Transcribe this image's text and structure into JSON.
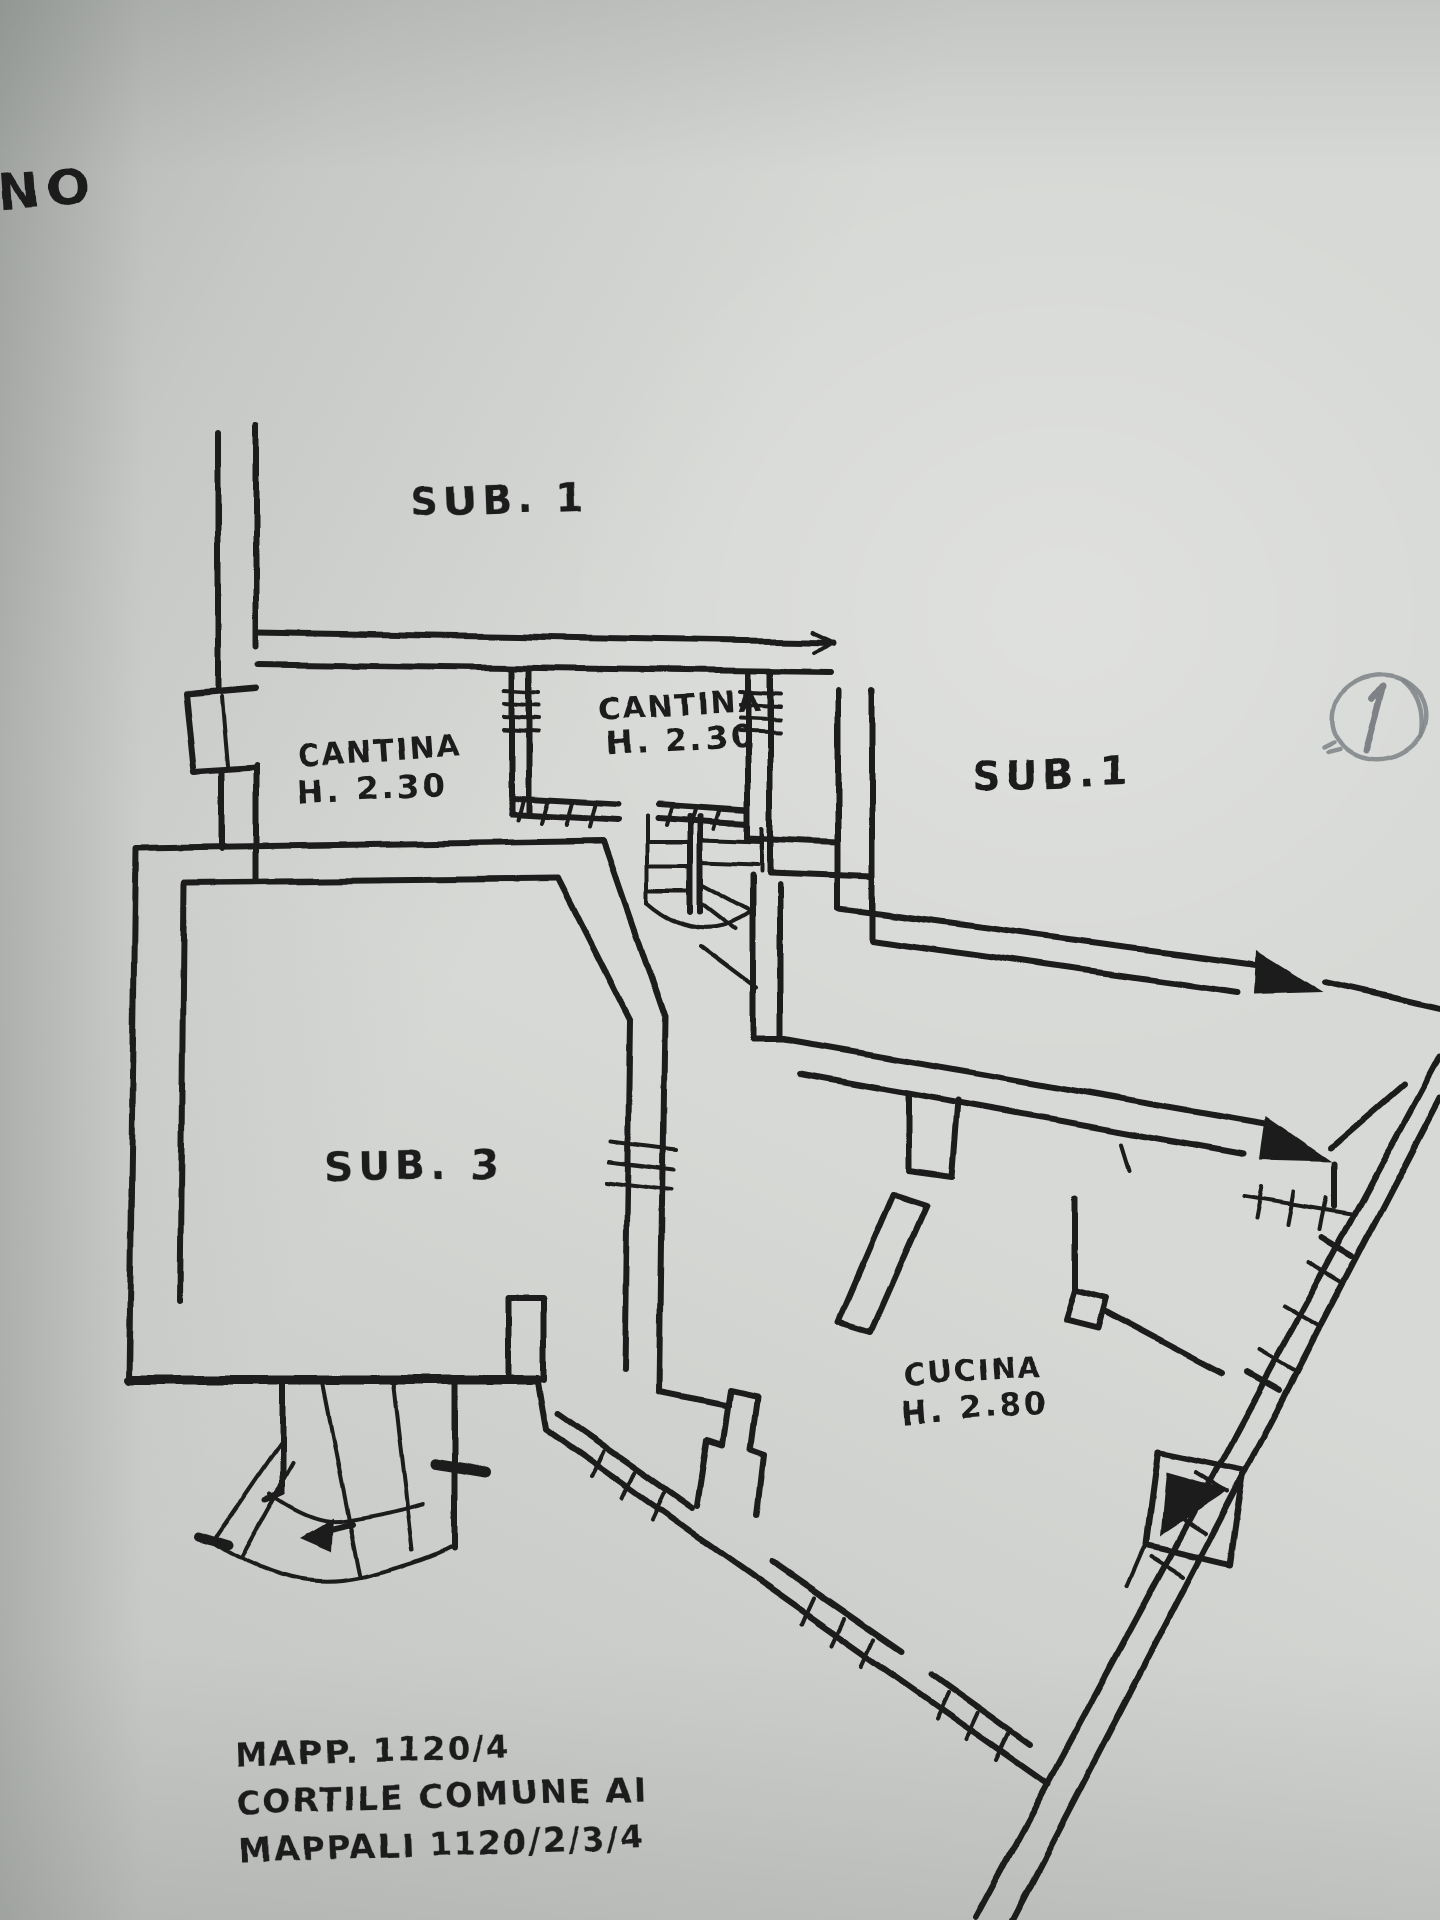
{
  "document": {
    "kind": "scanned hand-drawn cadastral basement floor plan",
    "sheet_number": "1",
    "top_left_fragment": "ENO"
  },
  "labels": {
    "sub1_top": "SUB. 1",
    "sub1_right": "SUB.1",
    "sub3": "SUB. 3",
    "cantina_left": {
      "line1": "CANTINA",
      "line2": "H. 2.30"
    },
    "cantina_right": {
      "line1": "CANTINA",
      "line2": "H. 2.30"
    },
    "cucina": {
      "line1": "CUCINA",
      "line2": "H. 2.80"
    }
  },
  "footer_note": {
    "line1": "MAPP. 1120/4",
    "line2": "CORTILE COMUNE AI",
    "line3": "MAPPALI 1120/2/3/4"
  },
  "colors": {
    "paper": "#d7d9d6",
    "ink": "#1b1b1b",
    "pencil": "#83878b"
  }
}
